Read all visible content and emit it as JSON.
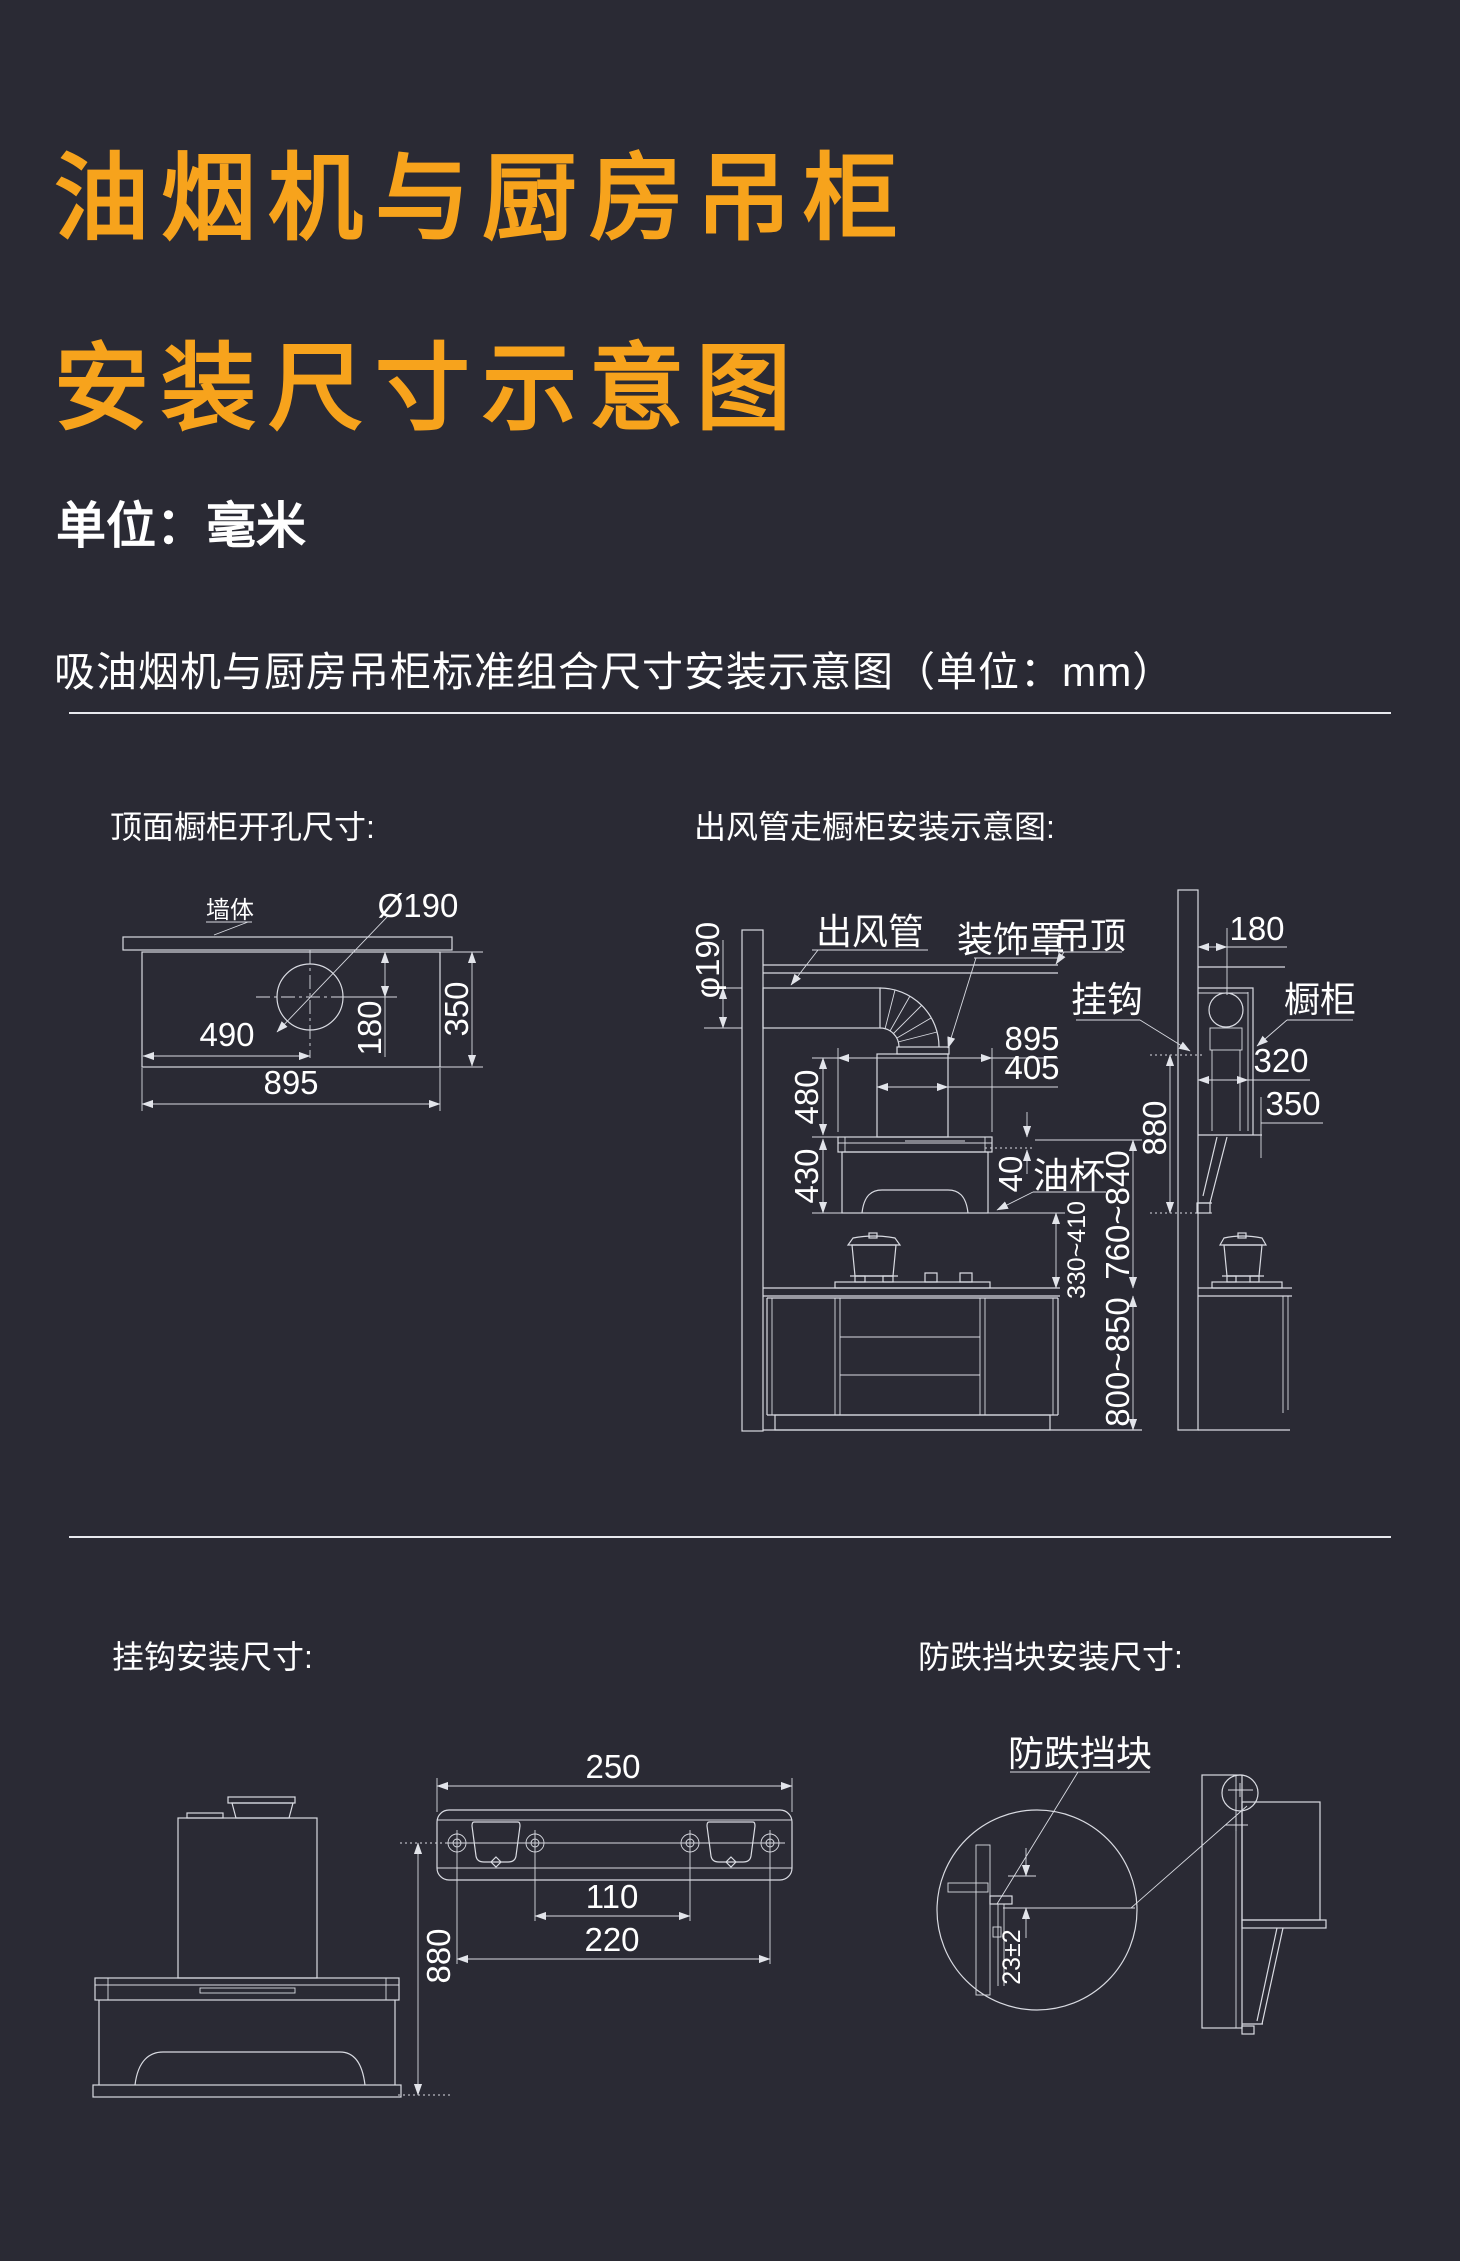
{
  "colors": {
    "bg": "#2a2a34",
    "accent": "#f7a31c",
    "line": "#d9dbe2",
    "text": "#ffffff"
  },
  "header": {
    "title_line1": "油烟机与厨房吊柜",
    "title_line2": "安装尺寸示意图",
    "unit_note": "单位：毫米",
    "caption": "吸油烟机与厨房吊柜标准组合尺寸安装示意图（单位：mm）"
  },
  "top_view": {
    "title": "顶面橱柜开孔尺寸:",
    "wall_label": "墙体",
    "hole_dia": "Ø190",
    "dim_490": "490",
    "dim_895": "895",
    "dim_180": "180",
    "dim_350": "350"
  },
  "duct_view": {
    "title": "出风管走橱柜安装示意图:",
    "duct_label": "出风管",
    "cover_label": "装饰罩",
    "ceiling_label": "吊顶",
    "hook_label": "挂钩",
    "cabinet_label": "橱柜",
    "oilcup_label": "油杯",
    "dim_phi190": "φ190",
    "dim_895": "895",
    "dim_405": "405",
    "dim_480": "480",
    "dim_430": "430",
    "dim_40": "40",
    "dim_180": "180",
    "dim_320": "320",
    "dim_350": "350",
    "dim_880": "880",
    "dim_330_410": "330~410",
    "dim_760_840": "760~840",
    "dim_800_850": "800~850"
  },
  "hook_view": {
    "title": "挂钩安装尺寸:",
    "dim_250": "250",
    "dim_110": "110",
    "dim_220": "220",
    "dim_880": "880"
  },
  "block_view": {
    "title": "防跌挡块安装尺寸:",
    "block_label": "防跌挡块",
    "dim_23": "23±2"
  }
}
